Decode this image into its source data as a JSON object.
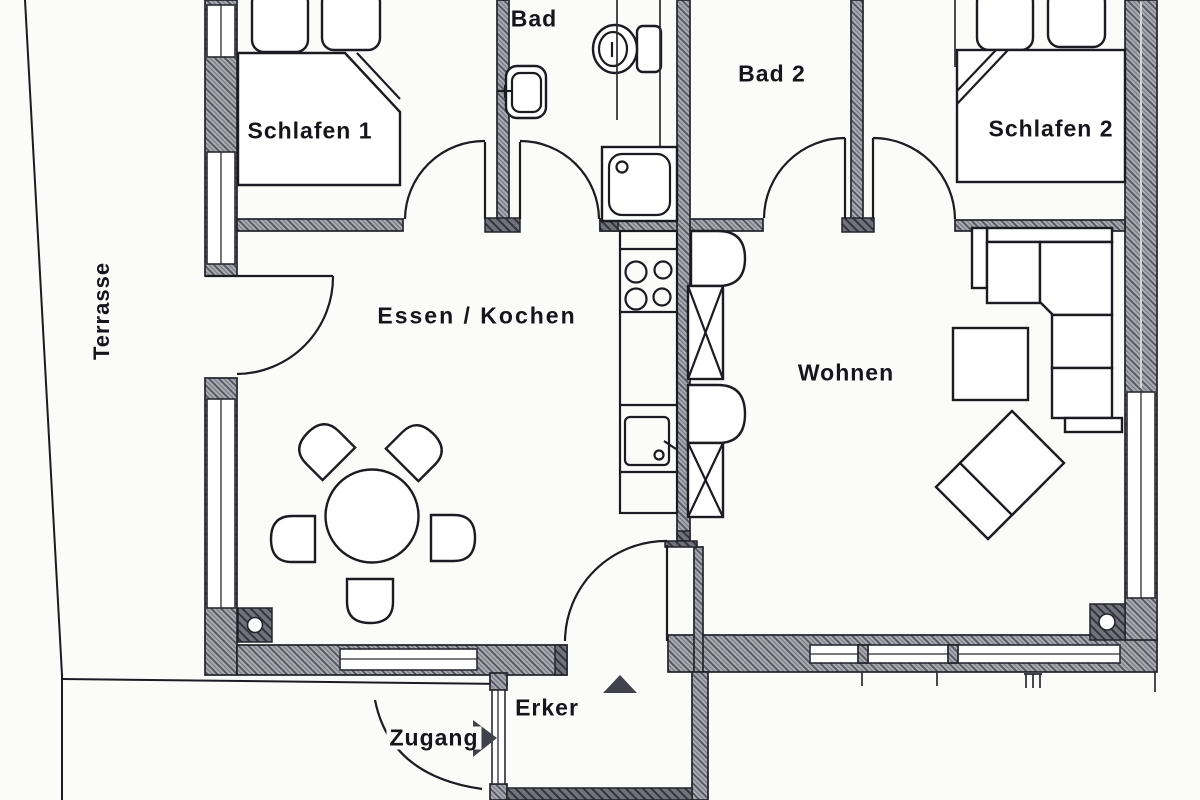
{
  "document": {
    "kind": "scanned architectural floor plan",
    "language": "German"
  },
  "labels": {
    "terrasse": "Terrasse",
    "schlafen1": "Schlafen 1",
    "bad": "Bad",
    "bad2": "Bad 2",
    "schlafen2": "Schlafen 2",
    "essen_kochen": "Essen / Kochen",
    "wohnen": "Wohnen",
    "erker": "Erker",
    "zugang": "Zugang"
  },
  "colors": {
    "paper": "#fbfbf9",
    "ink": "#1b1b22",
    "wall_hatch_light": "#aeaeb6",
    "wall_hatch_dark": "#72727c",
    "marker_fill": "#41414c"
  }
}
